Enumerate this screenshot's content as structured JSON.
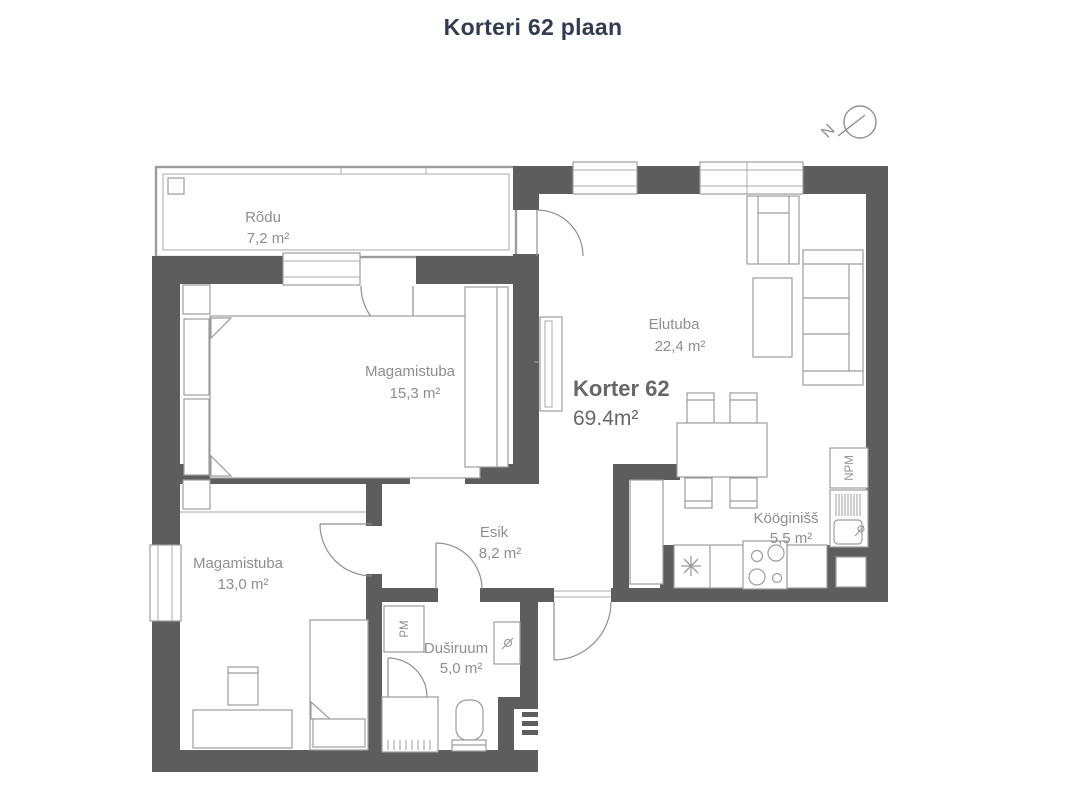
{
  "title": "Korteri 62 plaan",
  "compass": {
    "north": "N"
  },
  "apartment": {
    "label": "Korter 62",
    "area": "69.4m²"
  },
  "rooms": {
    "balcony": {
      "name": "Rõdu",
      "area": "7,2 m²"
    },
    "bedroom1": {
      "name": "Magamistuba",
      "area": "15,3 m²"
    },
    "living": {
      "name": "Elutuba",
      "area": "22,4 m²"
    },
    "kitchen": {
      "name": "Kööginišš",
      "area": "5,5 m²"
    },
    "hall": {
      "name": "Esik",
      "area": "8,2 m²"
    },
    "bedroom2": {
      "name": "Magamistuba",
      "area": "13,0 m²"
    },
    "shower": {
      "name": "Duširuum",
      "area": "5,0 m²"
    }
  },
  "appliances": {
    "dishwasher": "NPM",
    "washer": "PM"
  },
  "colors": {
    "wall": "#5d5d5d",
    "furniture_line": "#9c9c9c",
    "label_text": "#8e8e8e",
    "apartment_text": "#676767",
    "title_text": "#323c50",
    "background": "#ffffff"
  }
}
